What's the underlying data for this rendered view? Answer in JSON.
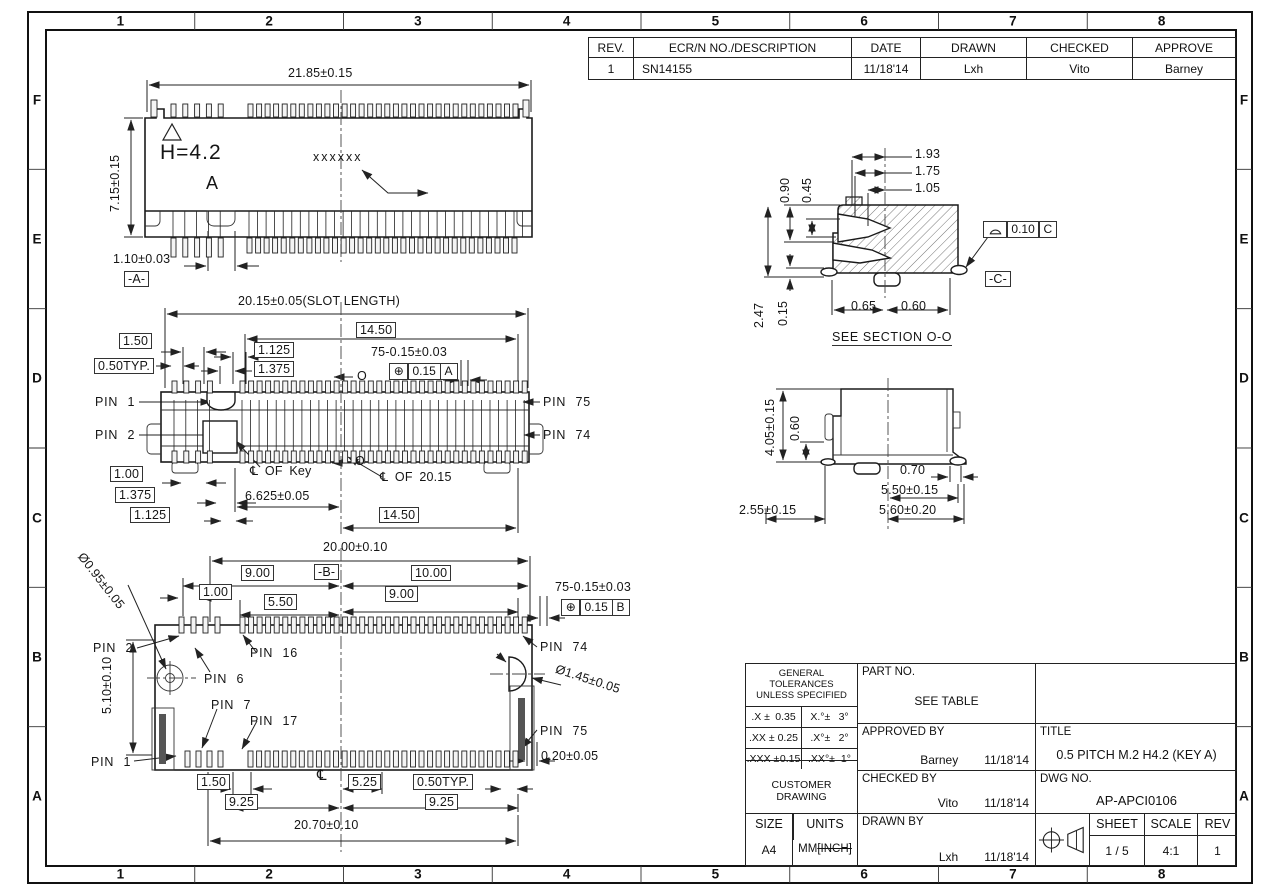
{
  "frame": {
    "columns": [
      "1",
      "2",
      "3",
      "4",
      "5",
      "6",
      "7",
      "8"
    ],
    "rows": [
      "F",
      "E",
      "D",
      "C",
      "B",
      "A"
    ]
  },
  "symbols": {
    "position": "⊕",
    "centerline": "℄"
  },
  "revision_table": {
    "headers": [
      "REV.",
      "ECR/N NO./DESCRIPTION",
      "DATE",
      "DRAWN",
      "CHECKED",
      "APPROVE"
    ],
    "row": [
      "1",
      "SN14155",
      "11/18'14",
      "Lxh",
      "Vito",
      "Barney"
    ]
  },
  "title_block": {
    "gt_title1": "GENERAL TOLERANCES",
    "gt_title2": "UNLESS  SPECIFIED",
    "gt": {
      "rows": [
        [
          ".X ±",
          "0.35",
          "X.°±",
          "3°"
        ],
        [
          ".XX ±",
          "0.25",
          ".X°±",
          "2°"
        ],
        [
          ".XXX ±",
          "0.15",
          ".XX°±",
          "1°"
        ]
      ]
    },
    "customer_drawing": "CUSTOMER DRAWING",
    "part_no_label": "PART NO.",
    "part_no_value": "SEE TABLE",
    "approved_label": "APPROVED BY",
    "approved_name": "Barney",
    "approved_date": "11/18'14",
    "checked_label": "CHECKED BY",
    "checked_name": "Vito",
    "checked_date": "11/18'14",
    "drawn_label": "DRAWN BY",
    "drawn_name": "Lxh",
    "drawn_date": "11/18'14",
    "title_label": "TITLE",
    "title_value": "0.5 PITCH M.2 H4.2 (KEY A)",
    "dwg_label": "DWG NO.",
    "dwg_value": "AP-APCI0106",
    "size_label": "SIZE",
    "size_value": "A4",
    "units_label": "UNITS",
    "units_mm": "MM",
    "units_inch": "[INCH]",
    "sheet_label": "SHEET",
    "sheet_value": "1 / 5",
    "scale_label": "SCALE",
    "scale_value": "4:1",
    "rev_label": "REV",
    "rev_value": "1"
  },
  "front": {
    "width": "21.85±0.15",
    "height": "7.15±0.15",
    "h_label": "H=4.2",
    "datum_target": "A",
    "marking": "xxxxxx",
    "tail_width": "1.10±0.03",
    "datum_a": "-A-"
  },
  "plan": {
    "slot_length": "20.15±0.05(SLOT LENGTH)",
    "d1450_top": "14.50",
    "d150": "1.50",
    "d1125_top": "1.125",
    "d050typ": "0.50TYP.",
    "d1375_top": "1.375",
    "pins_tol": "75-0.15±0.03",
    "fcf_tol": "0.15",
    "fcf_datum": "A",
    "section_o_top": "O",
    "section_o_bot": "O",
    "pin1": "PIN 1",
    "pin2": "PIN 2",
    "pin75": "PIN 75",
    "pin74": "PIN 74",
    "cl_of_key": "℄ OF Key",
    "cl_of_2015": "℄ OF 20.15",
    "d100": "1.00",
    "d1375_bot": "1.375",
    "d6625": "6.625±0.05",
    "d1125_bot": "1.125",
    "d1450_bot": "14.50"
  },
  "bottom": {
    "hole_dia": "Ø0.95±0.05",
    "d2000": "20.00±0.10",
    "datum_b": "-B-",
    "d900l": "9.00",
    "d1000": "10.00",
    "d100": "1.00",
    "d550": "5.50",
    "d900r": "9.00",
    "pins_tol": "75-0.15±0.03",
    "fcf_tol": "0.15",
    "fcf_datum": "B",
    "pin2": "PIN 2",
    "pin16": "PIN 16",
    "pin74": "PIN 74",
    "pin6": "PIN 6",
    "pin7": "PIN 7",
    "pin17": "PIN 17",
    "pin75": "PIN 75",
    "pin1": "PIN 1",
    "dhole_dia": "Ø1.45±0.05",
    "d510": "5.10±0.10",
    "d020": "0.20±0.05",
    "d150": "1.50",
    "cl": "℄",
    "d525": "5.25",
    "d050typ": "0.50TYP.",
    "d925l": "9.25",
    "d925r": "9.25",
    "d2070": "20.70±0.10"
  },
  "section": {
    "d193": "1.93",
    "d175": "1.75",
    "d105": "1.05",
    "d090": "0.90",
    "d045": "0.45",
    "d247": "2.47",
    "d015": "0.15",
    "d065": "0.65",
    "d060": "0.60",
    "fcf_tol": "0.10",
    "fcf_datum": "C",
    "datum_c": "-C-",
    "caption": "SEE SECTION O-O"
  },
  "side": {
    "d405": "4.05±0.15",
    "d060": "0.60",
    "d070": "0.70",
    "d550": "5.50±0.15",
    "d255": "2.55±0.15",
    "d560": "5.60±0.20"
  }
}
